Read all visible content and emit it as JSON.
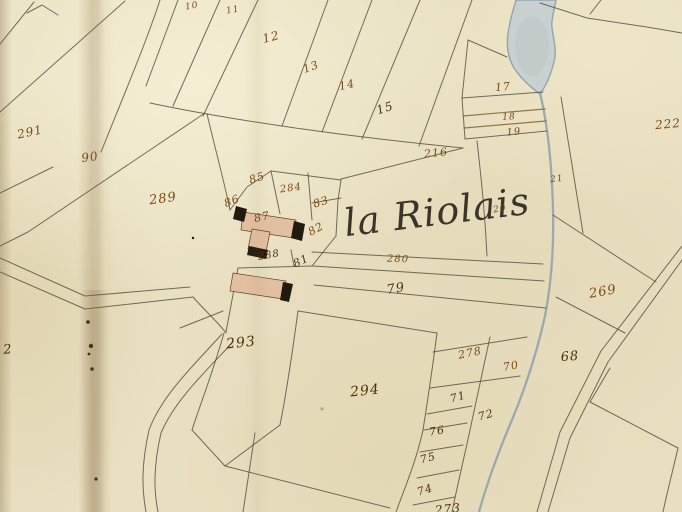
{
  "map": {
    "place_name": "la Riolais",
    "colors": {
      "paper": "#e9e0c2",
      "ink_line": "#54503e",
      "road_ink": "#8a6a3a",
      "number_ink": "#7c4a14",
      "number_ink_dark": "#4e3209",
      "water_fill": "#c7cfd3",
      "water_stroke": "#8da0ac",
      "building_fill": "#e2bfa0",
      "building_dark": "#221a10"
    },
    "features": {
      "pond": "pond-watercolor",
      "stream": "stream-line",
      "roads": "road-double-lines",
      "buildings": "building-footprints",
      "fold": "paper-fold-crease"
    },
    "parcel_numbers": [
      {
        "text": "10",
        "x": 192,
        "y": 7,
        "size": 9,
        "rot": -10
      },
      {
        "text": "11",
        "x": 233,
        "y": 11,
        "size": 9,
        "rot": -10
      },
      {
        "text": "12",
        "x": 271,
        "y": 37,
        "size": 12,
        "rot": -14
      },
      {
        "text": "13",
        "x": 311,
        "y": 67,
        "size": 11,
        "rot": -20
      },
      {
        "text": "14",
        "x": 347,
        "y": 85,
        "size": 11,
        "rot": -12
      },
      {
        "text": "15",
        "x": 385,
        "y": 108,
        "size": 12,
        "rot": -18,
        "dark": true
      },
      {
        "text": "17",
        "x": 503,
        "y": 87,
        "size": 11,
        "rot": -5
      },
      {
        "text": "18",
        "x": 509,
        "y": 118,
        "size": 9,
        "rot": -3
      },
      {
        "text": "19",
        "x": 514,
        "y": 133,
        "size": 10,
        "rot": -5
      },
      {
        "text": "222",
        "x": 668,
        "y": 124,
        "size": 12,
        "rot": -5
      },
      {
        "text": "291",
        "x": 30,
        "y": 132,
        "size": 12,
        "rot": -12
      },
      {
        "text": "90",
        "x": 90,
        "y": 157,
        "size": 12,
        "rot": -8
      },
      {
        "text": "289",
        "x": 163,
        "y": 199,
        "size": 13,
        "rot": -8
      },
      {
        "text": "216",
        "x": 436,
        "y": 153,
        "size": 11,
        "rot": -6
      },
      {
        "text": "21",
        "x": 557,
        "y": 180,
        "size": 9,
        "rot": -8
      },
      {
        "text": "20",
        "x": 500,
        "y": 210,
        "size": 9,
        "rot": -10
      },
      {
        "text": "85",
        "x": 257,
        "y": 178,
        "size": 11,
        "rot": -18
      },
      {
        "text": "284",
        "x": 291,
        "y": 189,
        "size": 10,
        "rot": -8
      },
      {
        "text": "86",
        "x": 232,
        "y": 201,
        "size": 11,
        "rot": -22
      },
      {
        "text": "83",
        "x": 321,
        "y": 202,
        "size": 11,
        "rot": -18
      },
      {
        "text": "87",
        "x": 262,
        "y": 217,
        "size": 11,
        "rot": -12
      },
      {
        "text": "82",
        "x": 316,
        "y": 229,
        "size": 11,
        "rot": -28
      },
      {
        "text": "288",
        "x": 269,
        "y": 256,
        "size": 10,
        "rot": -10,
        "dark": true
      },
      {
        "text": "81",
        "x": 301,
        "y": 261,
        "size": 11,
        "rot": -25,
        "dark": true
      },
      {
        "text": "280",
        "x": 398,
        "y": 260,
        "size": 10,
        "rot": 2
      },
      {
        "text": "79",
        "x": 396,
        "y": 289,
        "size": 13,
        "rot": -10,
        "dark": true
      },
      {
        "text": "269",
        "x": 603,
        "y": 292,
        "size": 13,
        "rot": -10
      },
      {
        "text": "278",
        "x": 470,
        "y": 353,
        "size": 11,
        "rot": -12
      },
      {
        "text": "70",
        "x": 511,
        "y": 366,
        "size": 11,
        "rot": -10
      },
      {
        "text": "68",
        "x": 570,
        "y": 357,
        "size": 13,
        "rot": -5,
        "dark": true
      },
      {
        "text": "71",
        "x": 458,
        "y": 397,
        "size": 11,
        "rot": -15,
        "dark": true
      },
      {
        "text": "72",
        "x": 486,
        "y": 415,
        "size": 11,
        "rot": -15,
        "dark": true
      },
      {
        "text": "76",
        "x": 437,
        "y": 431,
        "size": 11,
        "rot": -10,
        "dark": true
      },
      {
        "text": "75",
        "x": 428,
        "y": 458,
        "size": 11,
        "rot": -15,
        "dark": true
      },
      {
        "text": "74",
        "x": 425,
        "y": 490,
        "size": 11,
        "rot": -18,
        "dark": true
      },
      {
        "text": "273",
        "x": 448,
        "y": 509,
        "size": 12,
        "rot": -6,
        "dark": true
      },
      {
        "text": "293",
        "x": 241,
        "y": 343,
        "size": 14,
        "rot": -6,
        "dark": true
      },
      {
        "text": "294",
        "x": 365,
        "y": 391,
        "size": 14,
        "rot": -6,
        "dark": true
      },
      {
        "text": "2",
        "x": 8,
        "y": 350,
        "size": 13,
        "rot": -5,
        "dark": true
      }
    ]
  }
}
